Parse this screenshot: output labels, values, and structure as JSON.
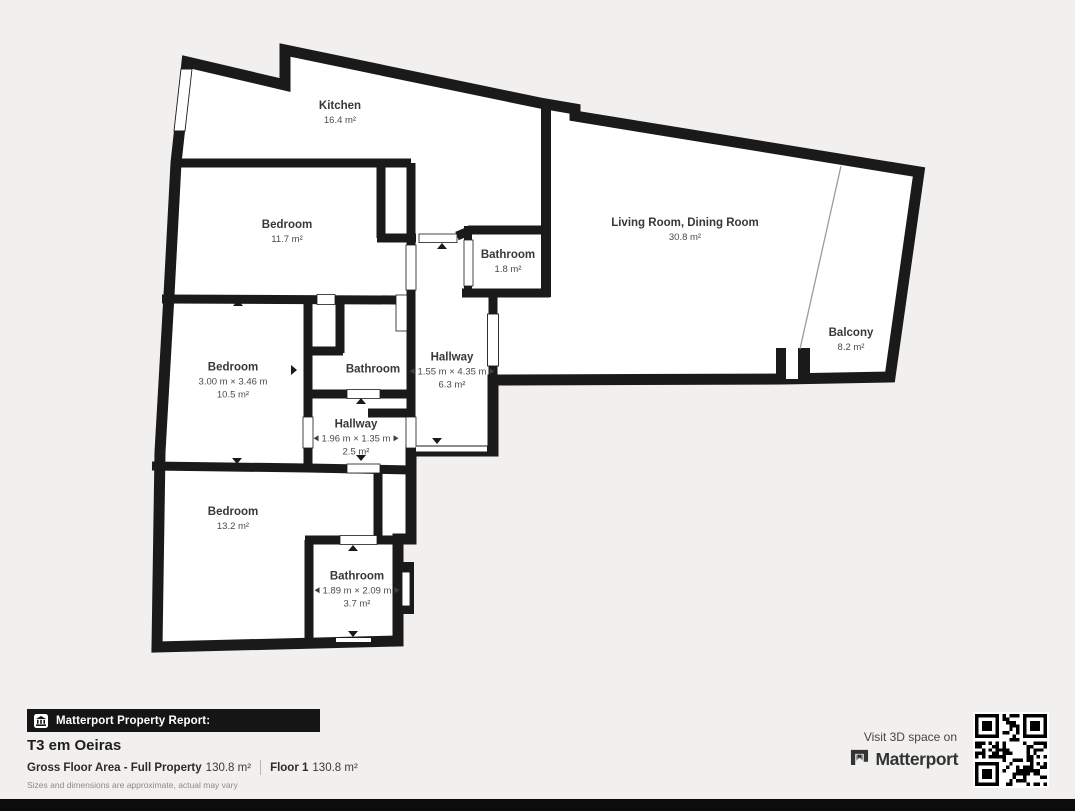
{
  "plan": {
    "rooms": [
      {
        "name": "Kitchen",
        "area": "16.4 m²",
        "x": 340,
        "y": 113
      },
      {
        "name": "Bedroom",
        "area": "11.7 m²",
        "x": 287,
        "y": 232
      },
      {
        "name": "Bathroom",
        "area": "1.8 m²",
        "x": 508,
        "y": 262
      },
      {
        "name": "Living Room, Dining Room",
        "area": "30.8 m²",
        "x": 685,
        "y": 230
      },
      {
        "name": "Balcony",
        "area": "8.2 m²",
        "x": 851,
        "y": 340
      },
      {
        "name": "Bedroom",
        "dims": "3.00 m × 3.46 m",
        "area": "10.5 m²",
        "x": 233,
        "y": 381
      },
      {
        "name": "Bathroom",
        "x": 373,
        "y": 370
      },
      {
        "name": "Hallway",
        "dims": "1.55 m × 4.35 m",
        "area": "6.3 m²",
        "dim_arrows": true,
        "x": 452,
        "y": 371
      },
      {
        "name": "Hallway",
        "dims": "1.96 m × 1.35 m",
        "area": "2.5 m²",
        "dim_arrows": true,
        "x": 356,
        "y": 438
      },
      {
        "name": "Bedroom",
        "area": "13.2 m²",
        "x": 233,
        "y": 519
      },
      {
        "name": "Bathroom",
        "dims": "1.89 m × 2.09 m",
        "area": "3.7 m²",
        "dim_arrows": true,
        "x": 357,
        "y": 590
      }
    ]
  },
  "footer": {
    "report_label": "Matterport Property Report:",
    "property_title": "T3 em Oeiras",
    "gfa_label": "Gross Floor Area - Full Property",
    "gfa_value": "130.8 m²",
    "floor_label": "Floor 1",
    "floor_value": "130.8 m²",
    "disclaimer": "Sizes and dimensions are approximate, actual may vary"
  },
  "promo": {
    "visit_text": "Visit 3D space on",
    "brand": "Matterport"
  },
  "colors": {
    "background": "#f1f0ee",
    "wall": "#1a1a1a",
    "room_fill": "#ffffff",
    "label_text": "#3c3c3c",
    "banner_bg": "#151515",
    "banner_text": "#ffffff"
  }
}
